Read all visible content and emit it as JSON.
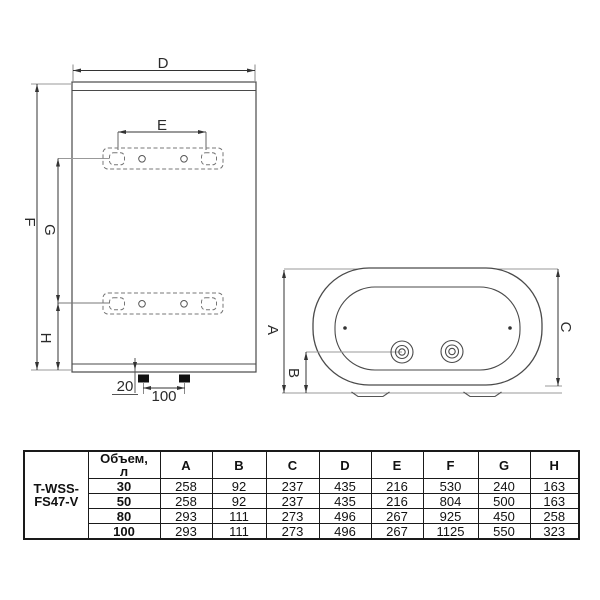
{
  "front_view": {
    "dim_d": "D",
    "dim_e": "E",
    "dim_f": "F",
    "dim_g": "G",
    "dim_h": "H",
    "dim_pipe_offset": "20",
    "dim_pipe_spacing": "100"
  },
  "bottom_view": {
    "dim_a": "A",
    "dim_b": "B",
    "dim_c": "C"
  },
  "table": {
    "model_lines": [
      "T-WSS-",
      "FS47-V"
    ],
    "volume_header_lines": [
      "Объем,",
      "л"
    ],
    "columns": [
      "A",
      "B",
      "C",
      "D",
      "E",
      "F",
      "G",
      "H"
    ],
    "rows": [
      {
        "volume": "30",
        "values": [
          "258",
          "92",
          "237",
          "435",
          "216",
          "530",
          "240",
          "163"
        ]
      },
      {
        "volume": "50",
        "values": [
          "258",
          "92",
          "237",
          "435",
          "216",
          "804",
          "500",
          "163"
        ]
      },
      {
        "volume": "80",
        "values": [
          "293",
          "111",
          "273",
          "496",
          "267",
          "925",
          "450",
          "258"
        ]
      },
      {
        "volume": "100",
        "values": [
          "293",
          "111",
          "273",
          "496",
          "267",
          "1125",
          "550",
          "323"
        ]
      }
    ]
  },
  "colors": {
    "outline": "#4a4a4a",
    "dim_line": "#333333",
    "extension_line": "#999999",
    "table_border": "#1a1a1a"
  }
}
